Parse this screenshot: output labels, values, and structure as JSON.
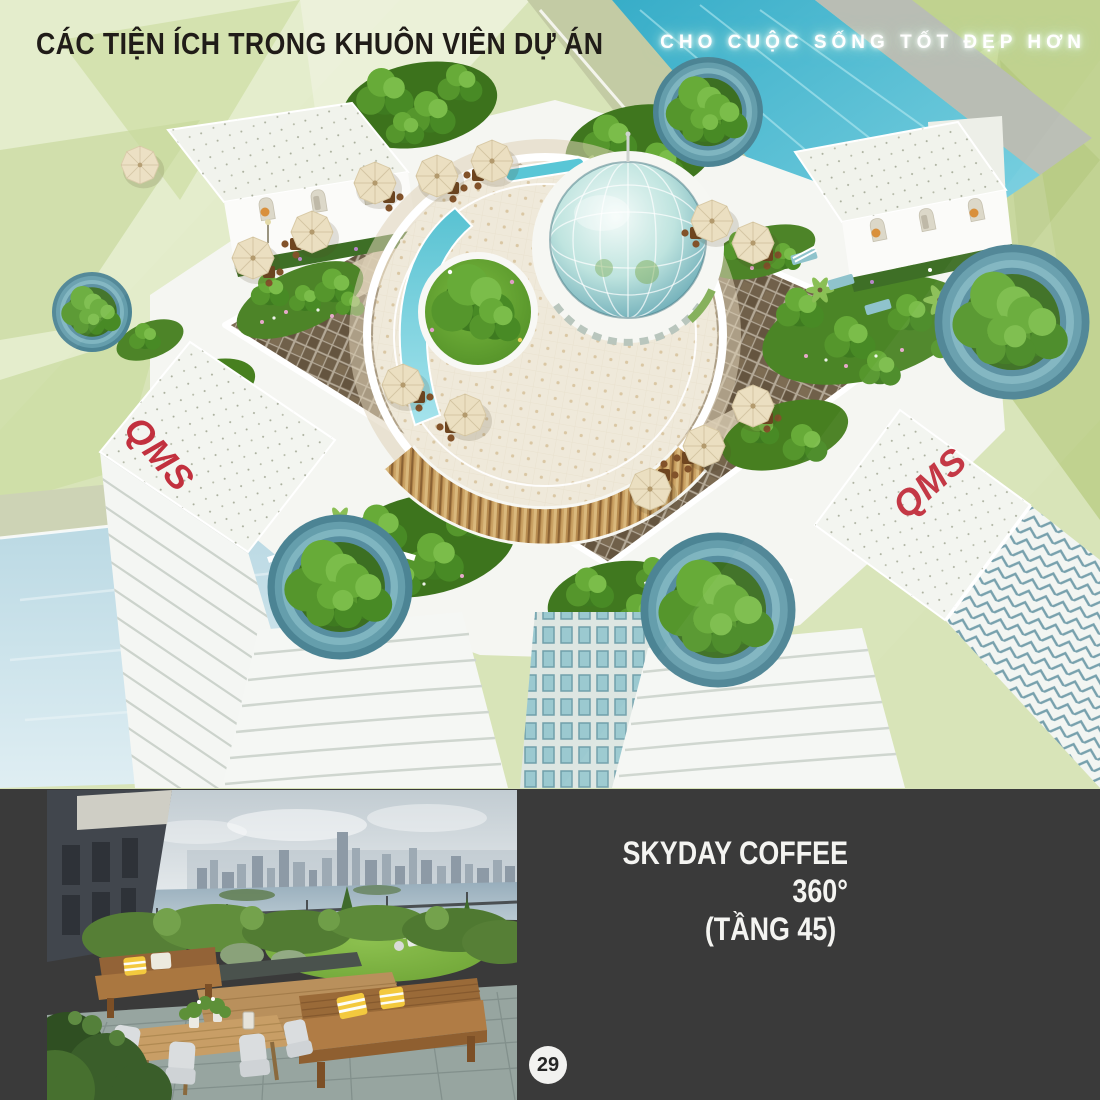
{
  "header": {
    "title": "CÁC TIỆN ÍCH TRONG KHUÔN VIÊN DỰ ÁN",
    "slogan": "CHO CUỘC SỐNG TỐT ĐẸP HƠN"
  },
  "branding": {
    "logo": "QMS"
  },
  "feature": {
    "line1": "SKYDAY COFFEE 360°",
    "line2": "(TẦNG 45)"
  },
  "footer": {
    "page_number": "29"
  },
  "colors": {
    "title_text": "#201c18",
    "slogan_text": "#ffffff",
    "band_background": "#3a3a3a",
    "logo_red": "#c2303e",
    "canal_water": "#4fbcd2",
    "dome_glass": "#72b0ba",
    "deck_lattice": "#70604a",
    "umbrella_cream": "#ebdfc1",
    "garden_green": "#4d8428",
    "planter_teal": "#659eac"
  }
}
